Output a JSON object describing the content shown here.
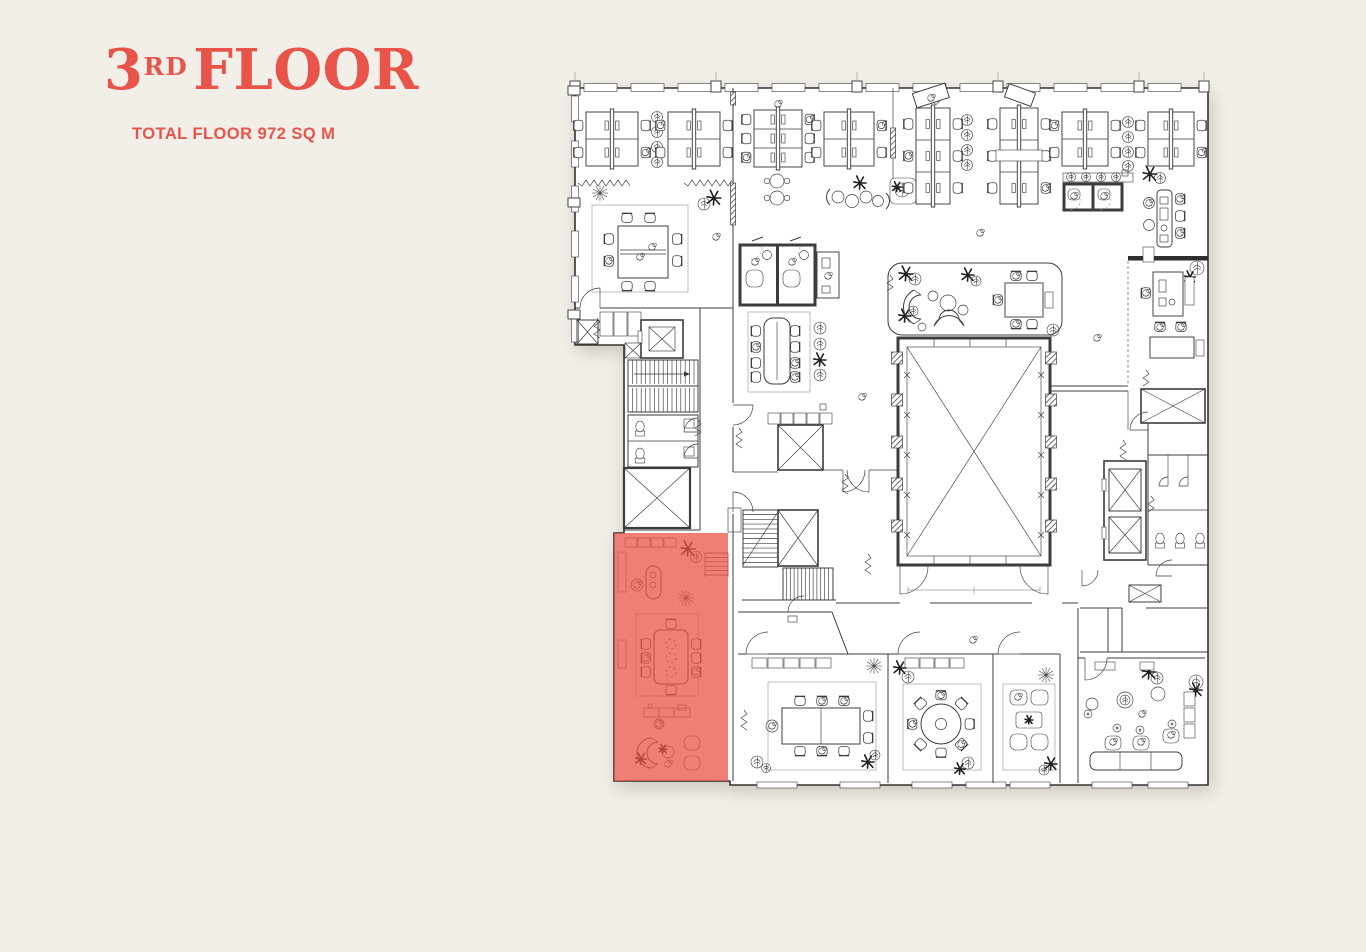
{
  "header": {
    "floor_number": "3",
    "floor_suffix": "RD",
    "floor_word": "FLOOR",
    "subtitle": "TOTAL FLOOR 972 SQ M"
  },
  "colors": {
    "page-bg": "#F2EFE9",
    "accent": "#E8544A",
    "highlight": "#E85449",
    "line": "#3C3C3C"
  }
}
